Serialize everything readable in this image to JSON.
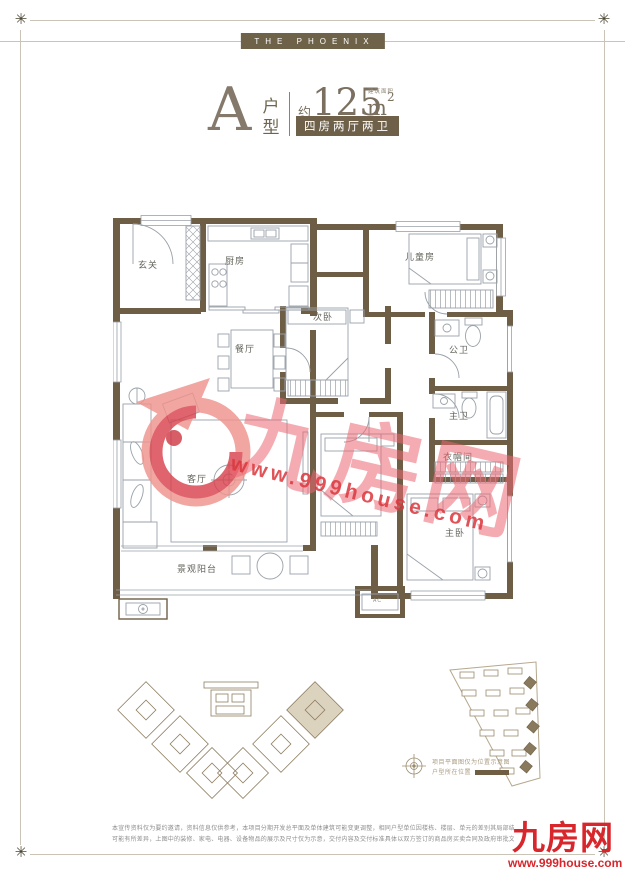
{
  "decor": {
    "corner_glyph": "✳"
  },
  "brand": {
    "badge": "THE PHOENIX"
  },
  "title": {
    "type_letter": "A",
    "type_label": "户型",
    "approx_prefix": "约",
    "area_value": "125",
    "area_unit": "m",
    "area_superscript": "2",
    "area_note": "建筑面积",
    "spec_badge": "四房两厅两卫"
  },
  "floorplan": {
    "rooms": {
      "entry": "玄关",
      "kitchen": "厨房",
      "dining": "餐厅",
      "living": "客厅",
      "second_bedroom": "次卧",
      "kids_room": "儿童房",
      "public_bath": "公卫",
      "master_bath": "主卫",
      "closet": "衣帽间",
      "master_bedroom": "主卧",
      "balcony": "景观阳台"
    },
    "ac_label": "AC"
  },
  "watermark": {
    "brand": "九房网",
    "url": "www.999house.com"
  },
  "siteplan": {
    "legend_line1": "项目平面图仅为位置示意图",
    "legend_line2": "户型所在位置"
  },
  "footer": {
    "disclaimer_line1": "本宣传资料仅为要约邀请，资料信息仅供参考，本项目分期开发总平面及单体建筑可能变更调整，相同户型单位因楼栋、楼层、单元的差别其局部结构、面",
    "disclaimer_line2": "可能有所差异，上图中的装修、家电、电器、设备物品的展示及尺寸仅为示意，交付内容及交付标准具体以双方签订的商品房买卖合同及政府审批文件为准。",
    "logo_name": "九房网",
    "logo_url": "www.999house.com"
  }
}
